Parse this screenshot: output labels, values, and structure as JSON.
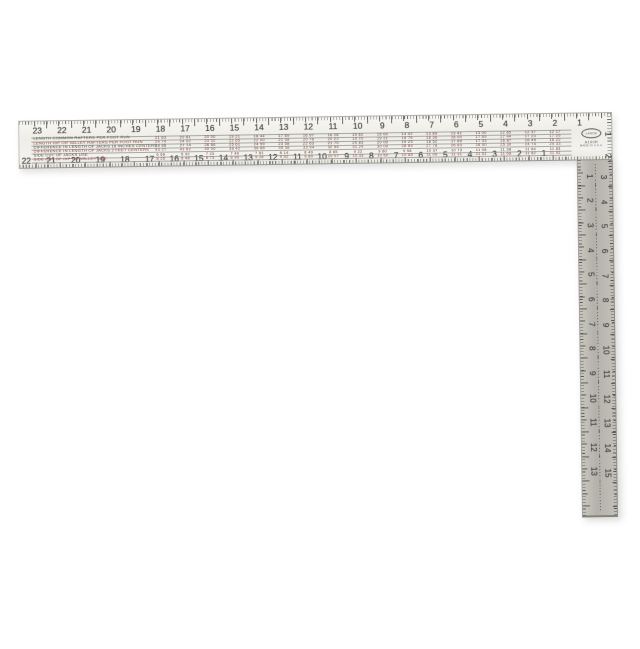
{
  "background_color": "#ffffff",
  "square": {
    "description": "steel framing square",
    "blade_color": "#f2f1ed",
    "tongue_color": "#b8b6af",
    "marking_color": "#45443e",
    "red_row_color": "#8e3b33",
    "logo": {
      "text": "LANCE",
      "model": "A100R",
      "line1": "MADE IN U.S.A."
    },
    "scales": {
      "blade_outer": [
        23,
        22,
        21,
        20,
        19,
        18,
        17,
        16,
        15,
        14,
        13,
        12,
        11,
        10,
        9,
        8,
        7,
        6,
        5,
        4,
        3,
        2,
        1
      ],
      "blade_inner": [
        22,
        21,
        20,
        19,
        18,
        17,
        16,
        15,
        14,
        13,
        12,
        11,
        10,
        9,
        8,
        7,
        6,
        5,
        4,
        3,
        2,
        1
      ],
      "blade_end": [
        1,
        2
      ],
      "tongue_inner": [
        1,
        2,
        3,
        4,
        5,
        6,
        7,
        8,
        9,
        10,
        11,
        12,
        13
      ],
      "tongue_outer": [
        3,
        4,
        5,
        6,
        7,
        8,
        9,
        10,
        11,
        12,
        13,
        14,
        15
      ]
    },
    "rafter_table": {
      "columns": [
        18,
        17,
        16,
        15,
        14,
        13,
        12,
        11,
        10,
        9,
        8,
        7,
        6,
        5,
        4,
        3,
        2
      ],
      "rows": [
        {
          "label": "LENGTH COMMON RAFTERS PER FOOT RUN",
          "color": "#45443e",
          "values": [
            "21 63",
            "20 81",
            "20 00",
            "19 21",
            "18 44",
            "17 69",
            "16 97",
            "16 28",
            "15 62",
            "15 00",
            "14 42",
            "13 89",
            "13 42",
            "13 00",
            "12 65",
            "12 37",
            "12 17"
          ]
        },
        {
          "label": "LENGTH HIP OR VALLEY RAFTERS PER FOOT RUN",
          "color": "#8e3b33",
          "values": [
            "24 74",
            "24 02",
            "23 32",
            "22 65",
            "22 00",
            "21 38",
            "20 78",
            "20 22",
            "19 70",
            "19 21",
            "18 76",
            "18 36",
            "18 00",
            "17 69",
            "17 44",
            "17 23",
            "17 09"
          ]
        },
        {
          "label": "DIFFERENCE IN LENGTH OF JACKS 16 INCHES CENTERS",
          "color": "#45443e",
          "values": [
            "28 88",
            "27 74",
            "26 66",
            "25 61",
            "24 59",
            "23 58",
            "22 63",
            "21 70",
            "20 83",
            "20 00",
            "19 23",
            "18 52",
            "17 89",
            "17 33",
            "16 87",
            "16 49",
            "16 22"
          ]
        },
        {
          "label": "DIFFERENCE IN LENGTH OF JACKS 2 FEET CENTERS",
          "color": "#8e3b33",
          "values": [
            "43 27",
            "41 62",
            "40 00",
            "38 42",
            "36 88",
            "35 38",
            "33 94",
            "32 56",
            "31 24",
            "30 00",
            "28 84",
            "27 78",
            "26 83",
            "26 00",
            "25 30",
            "24 74",
            "24 33"
          ]
        },
        {
          "label": "SIDE CUT OF JACKS USE",
          "color": "#45443e",
          "values": [
            "6 66",
            "6 92",
            "7 20",
            "7 49",
            "7 81",
            "8 14",
            "8 49",
            "8 85",
            "9 22",
            "9 60",
            "9 98",
            "10 37",
            "10 73",
            "11 08",
            "11 38",
            "11 64",
            "11 83"
          ]
        },
        {
          "label": "SIDE CUT OF HIP OR VALLEY USE",
          "color": "#8e3b33",
          "values": [
            "8 25",
            "8 48",
            "8 73",
            "8 99",
            "9 26",
            "9 52",
            "9 80",
            "10 07",
            "10 33",
            "10 60",
            "10 85",
            "11 09",
            "11 31",
            "11 51",
            "11 68",
            "11 82",
            "11 92"
          ]
        }
      ]
    }
  }
}
